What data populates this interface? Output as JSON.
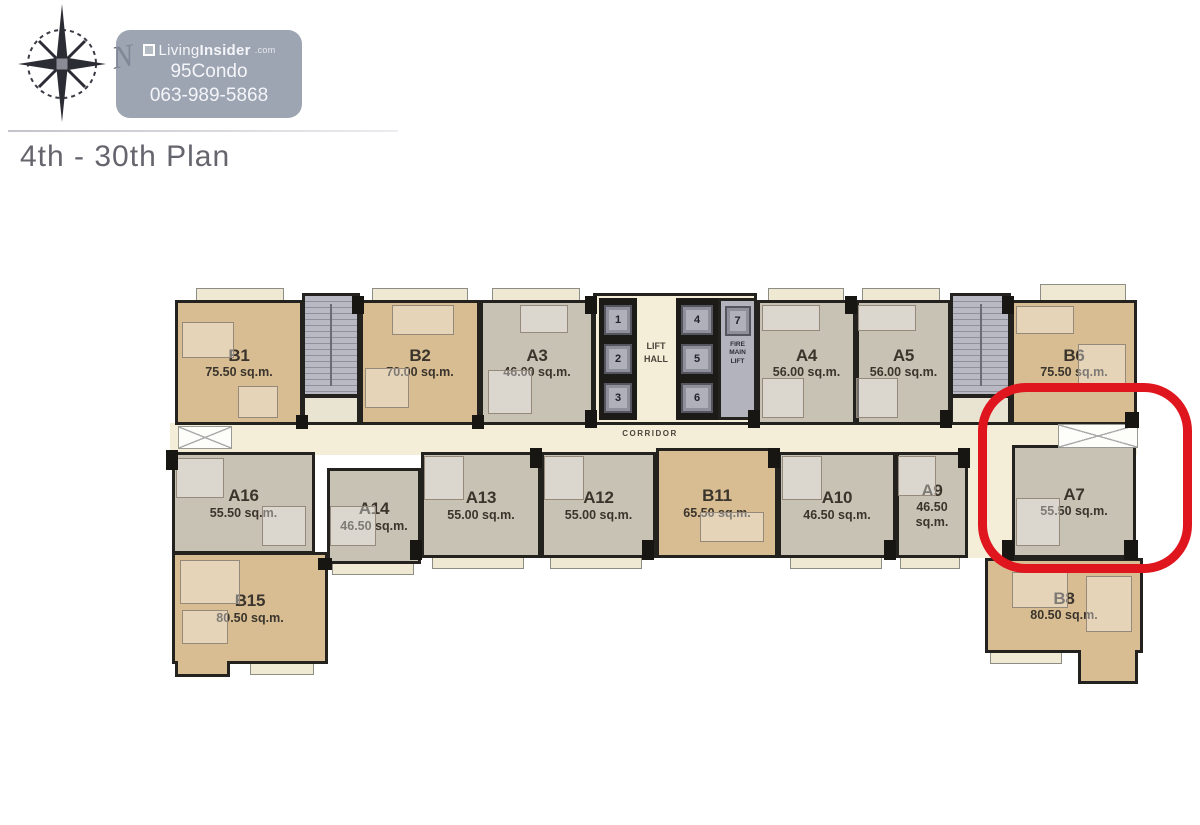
{
  "header": {
    "north": "N",
    "watermark": {
      "brand_light": "Living",
      "brand_bold": "Insider",
      "brand_suffix": ".com",
      "line2": "95Condo",
      "line3": "063-989-5868"
    },
    "title": "4th - 30th Plan"
  },
  "plan": {
    "corridor_label": "CORRIDOR",
    "lift_hall_label": "LIFT HALL",
    "fire_lift_label": "FIRE MAIN LIFT",
    "lifts": [
      "1",
      "2",
      "3",
      "4",
      "5",
      "6",
      "7"
    ],
    "highlight": {
      "unit": "A7",
      "color": "#e0161f"
    },
    "units": [
      {
        "id": "B1",
        "area": "75.50 sq.m."
      },
      {
        "id": "B2",
        "area": "70.00 sq.m."
      },
      {
        "id": "A3",
        "area": "46.00 sq.m."
      },
      {
        "id": "A4",
        "area": "56.00 sq.m."
      },
      {
        "id": "A5",
        "area": "56.00 sq.m."
      },
      {
        "id": "B6",
        "area": "75.50 sq.m."
      },
      {
        "id": "A16",
        "area": "55.50 sq.m."
      },
      {
        "id": "A14",
        "area": "46.50 sq.m."
      },
      {
        "id": "A13",
        "area": "55.00 sq.m."
      },
      {
        "id": "A12",
        "area": "55.00 sq.m."
      },
      {
        "id": "B11",
        "area": "65.50 sq.m."
      },
      {
        "id": "A10",
        "area": "46.50 sq.m."
      },
      {
        "id": "A9",
        "area": "46.50 sq.m."
      },
      {
        "id": "A7",
        "area": "55.50 sq.m."
      },
      {
        "id": "B15",
        "area": "80.50 sq.m."
      },
      {
        "id": "B8",
        "area": "80.50 sq.m."
      }
    ]
  }
}
